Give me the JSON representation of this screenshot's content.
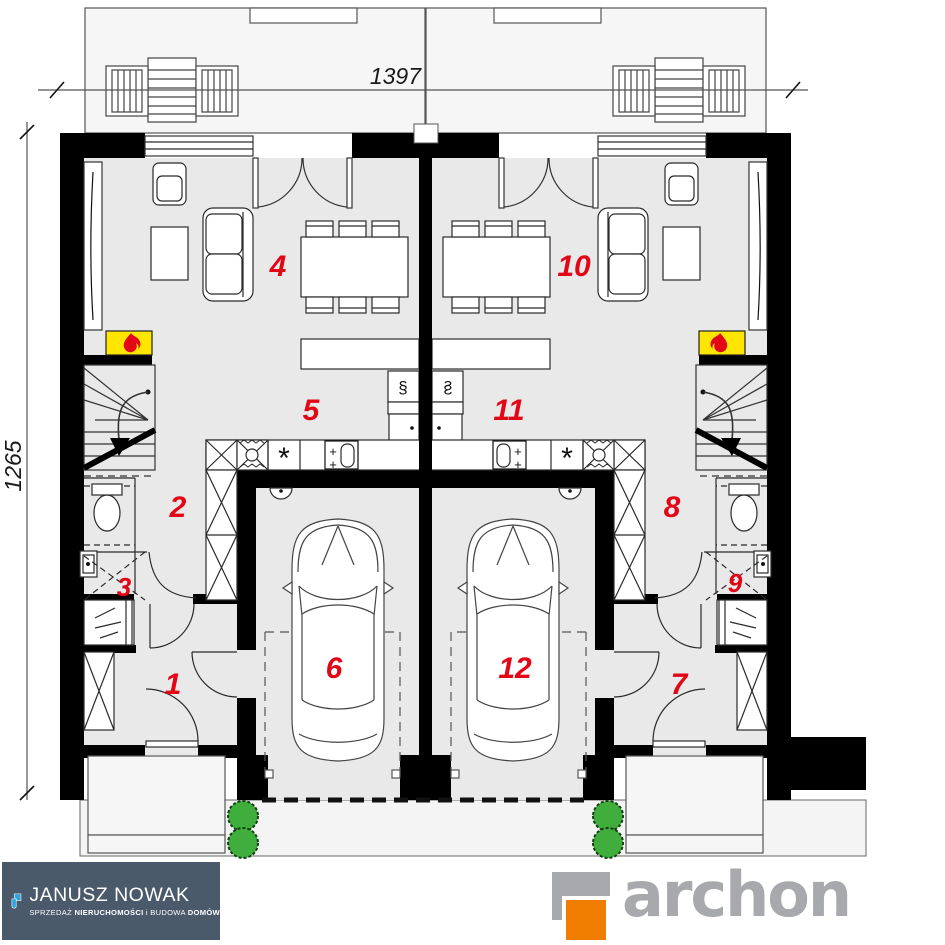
{
  "plan": {
    "dimensions": {
      "top": "1397",
      "left": "1265"
    },
    "room_numbers": [
      "1",
      "2",
      "3",
      "4",
      "5",
      "6",
      "7",
      "8",
      "9",
      "10",
      "11",
      "12"
    ],
    "icons": {
      "hob_spiral": "§",
      "burner_star": "*",
      "faucet_cross_1": "+",
      "faucet_cross_2": "+"
    },
    "colors": {
      "wall": "#000000",
      "floor": "#e9e9e9",
      "terrace": "#f6f6f6",
      "room_number_red": "#e30617",
      "fireplace_yellow": "#ffe600",
      "flame_red": "#e30617",
      "bush_green": "#3fae3c"
    }
  },
  "footer": {
    "janusz_nowak": {
      "name": "JANUSZ NOWAK",
      "tagline_part1": "SPRZEDAŻ ",
      "tagline_part2": "NIERUCHOMOŚCI",
      "tagline_part3": " i BUDOWA ",
      "tagline_part4": "DOMÓW",
      "bg_color": "#4a5a6b",
      "mark_blue": "#2ea3dc"
    },
    "archon": {
      "wordmark": "archon",
      "text_gray": "#a7a9ac",
      "square_orange": "#f07d00"
    }
  }
}
